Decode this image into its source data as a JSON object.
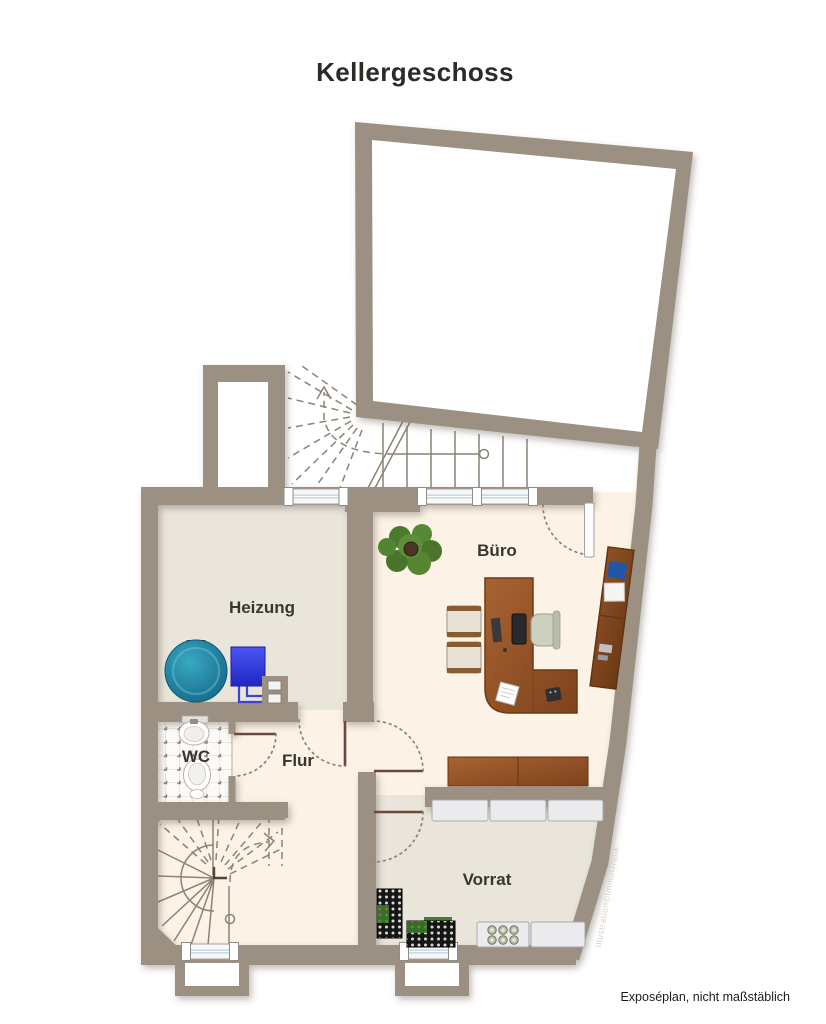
{
  "title": "Kellergeschoss",
  "rooms": {
    "heizung": {
      "label": "Heizung"
    },
    "buero": {
      "label": "Büro"
    },
    "wc": {
      "label": "WC"
    },
    "flur": {
      "label": "Flur"
    },
    "vorrat": {
      "label": "Vorrat"
    }
  },
  "footer": {
    "caption": "Exposéplan, nicht maßstäblich"
  },
  "watermark": "Illustration©ImmoGrafik",
  "colors": {
    "wall": "#9b9082",
    "floor_main": "#fcf2e6",
    "floor_utility": "#e9e5da",
    "window_glass": "#bfd6e2",
    "boiler_teal": "#1d84a0",
    "heater_blue": "#3038dd",
    "wood": "#9a5a2c",
    "plant_green": "#55862f"
  }
}
